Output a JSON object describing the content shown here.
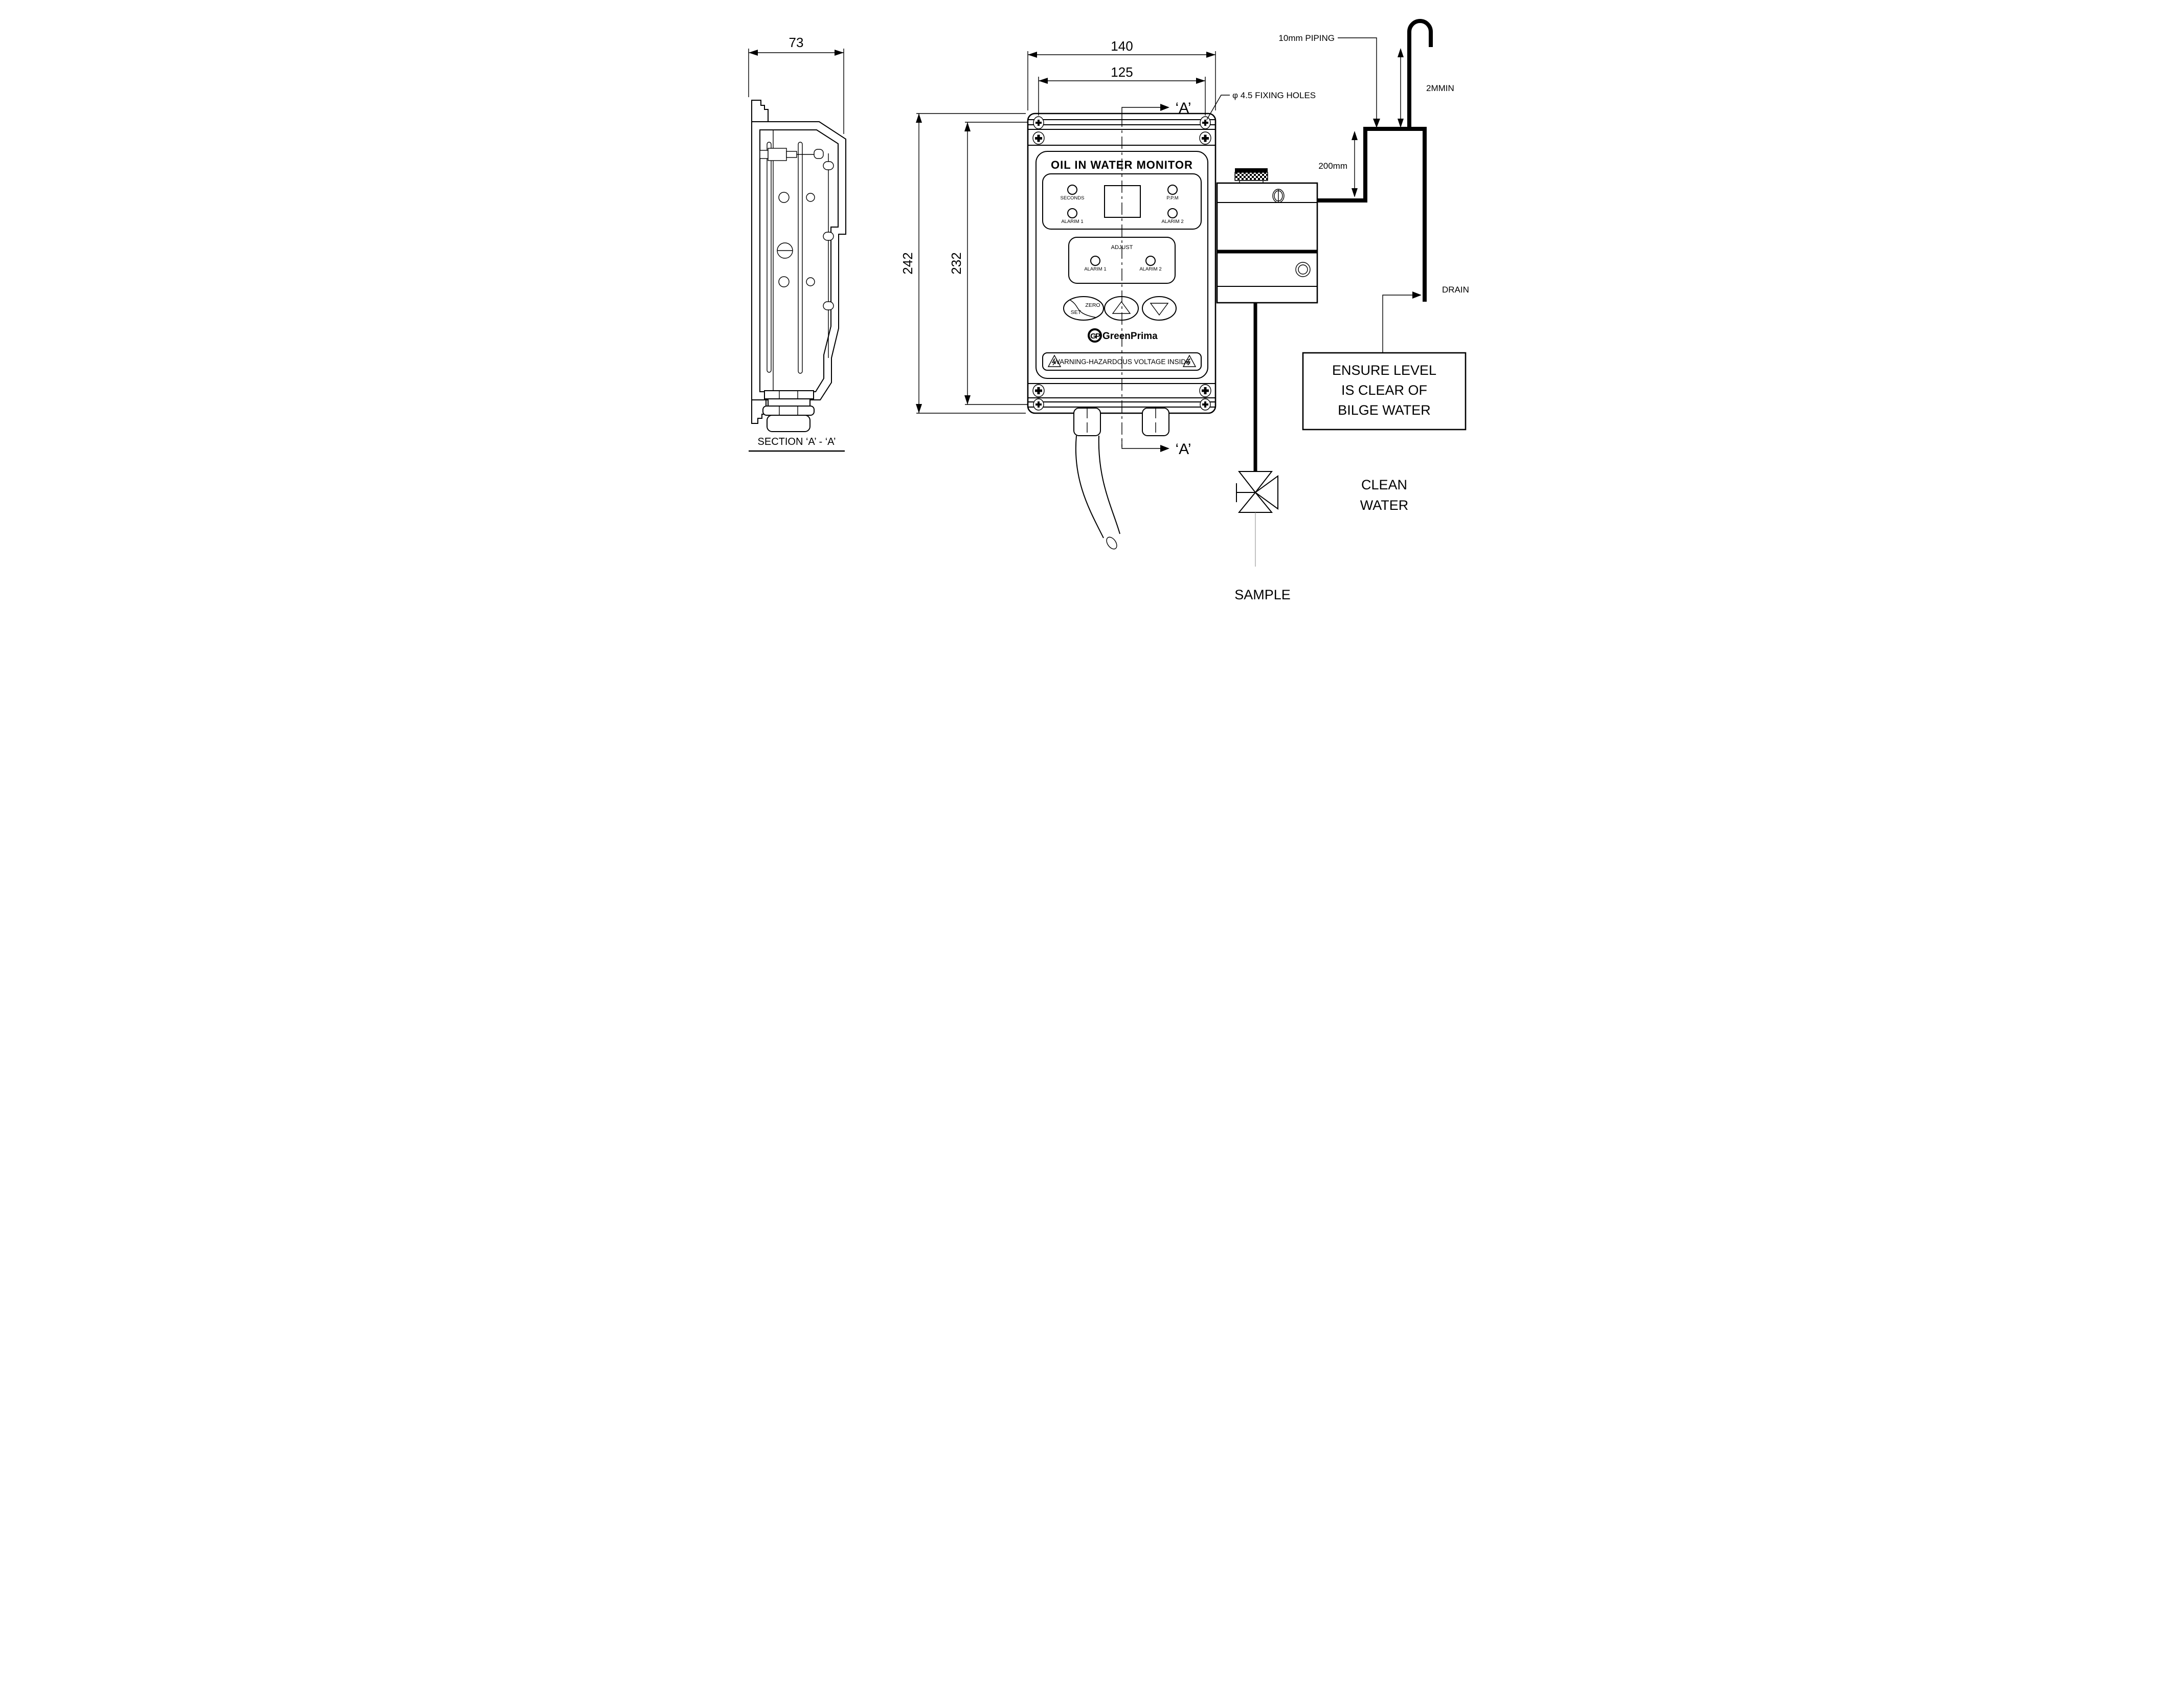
{
  "colors": {
    "ink": "#000000",
    "paper": "#ffffff"
  },
  "section_view": {
    "width_dim": "73",
    "caption": "SECTION  ‘A’ - ‘A’"
  },
  "front_view": {
    "overall_width": "140",
    "hole_spacing_h": "125",
    "overall_height": "242",
    "hole_spacing_v": "232",
    "fixing_holes_note": "φ 4.5 FIXING HOLES",
    "section_marker_top": "‘A’",
    "section_marker_bottom": "‘A’",
    "panel": {
      "title": "OIL IN WATER MONITOR",
      "led_seconds": "SECONDS",
      "led_ppm": "P.P.M",
      "led_alarm1": "ALARIM 1",
      "led_alarm2": "ALARIM 2",
      "adjust_title": "ADJUST",
      "adjust_alarm1": "ALARIM 1",
      "adjust_alarm2": "ALARIM 2",
      "btn_set": "SET",
      "btn_zero": "ZERO",
      "brand_icon": "GP",
      "brand": "GreenPrima",
      "warning": "WARNING-HAZARDOUS VOLTAGE INSIDE"
    }
  },
  "installation": {
    "piping_label": "10mm PIPING",
    "vent_height": "2MMIN",
    "loop_height": "200mm",
    "drain": "DRAIN",
    "level_note_line1": "ENSURE LEVEL",
    "level_note_line2": "IS CLEAR OF",
    "level_note_line3": "BILGE WATER",
    "clean_line1": "CLEAN",
    "clean_line2": "WATER",
    "sample": "SAMPLE"
  }
}
